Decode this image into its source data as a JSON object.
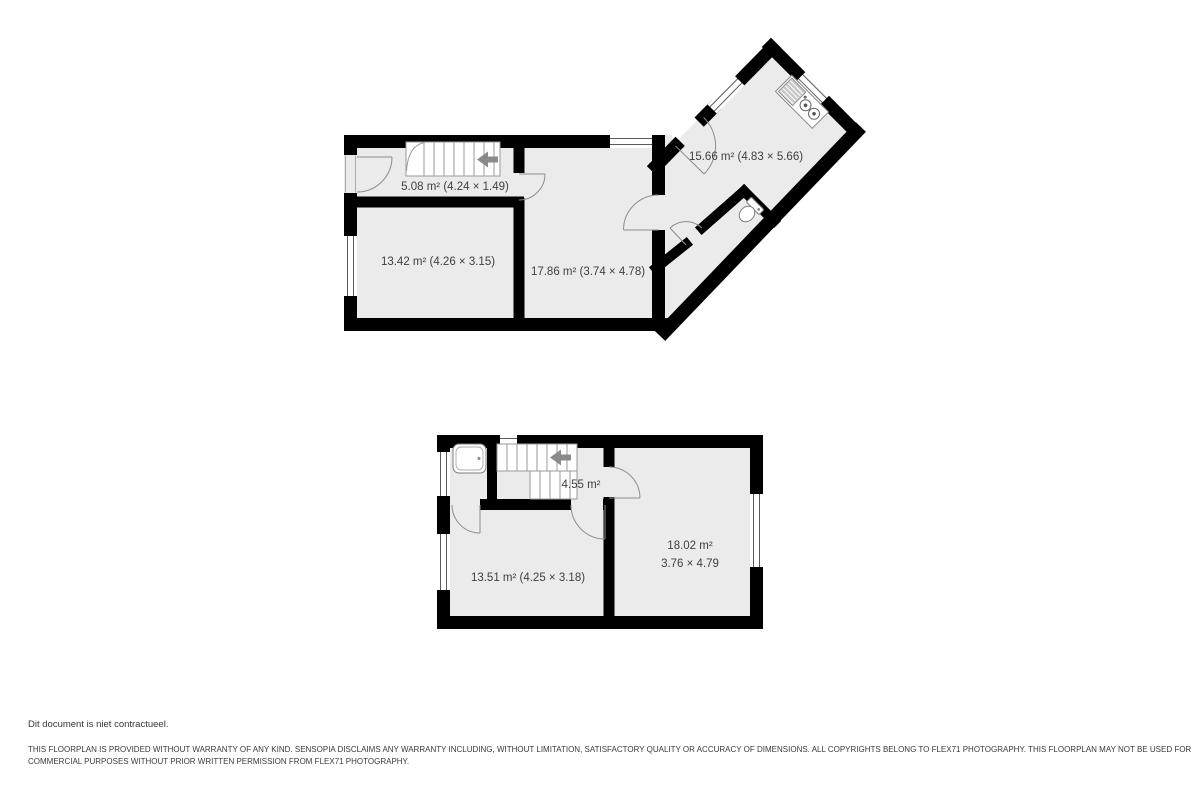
{
  "colors": {
    "wall": "#000000",
    "room_fill": "#ebebeb",
    "text": "#3f3f3f",
    "arrow": "#8a8a8a"
  },
  "plans": {
    "first_floor": {
      "hallway_label": "5.08 m² (4.24 × 1.49)",
      "room_front_label": "13.42 m² (4.26 × 3.15)",
      "room_middle_label": "17.86 m² (3.74 × 4.78)",
      "kitchen_label": "15.66 m² (4.83 × 5.66)"
    },
    "second_floor": {
      "landing_label": "4.55 m²",
      "bedroom_right_area": "18.02 m²",
      "bedroom_right_dims": "3.76 × 4.79",
      "bedroom_left_label": "13.51 m² (4.25 × 3.18)"
    }
  },
  "footer": {
    "note": "Dit document is niet contractueel.",
    "disclaimer_line1": "THIS FLOORPLAN IS PROVIDED WITHOUT WARRANTY OF ANY KIND. SENSOPIA DISCLAIMS ANY WARRANTY INCLUDING, WITHOUT LIMITATION, SATISFACTORY QUALITY OR ACCURACY OF DIMENSIONS. ALL COPYRIGHTS BELONG TO FLEX71 PHOTOGRAPHY. THIS FLOORPLAN MAY NOT BE USED FOR",
    "disclaimer_line2": "COMMERCIAL PURPOSES WITHOUT PRIOR WRITTEN PERMISSION FROM FLEX71 PHOTOGRAPHY."
  }
}
